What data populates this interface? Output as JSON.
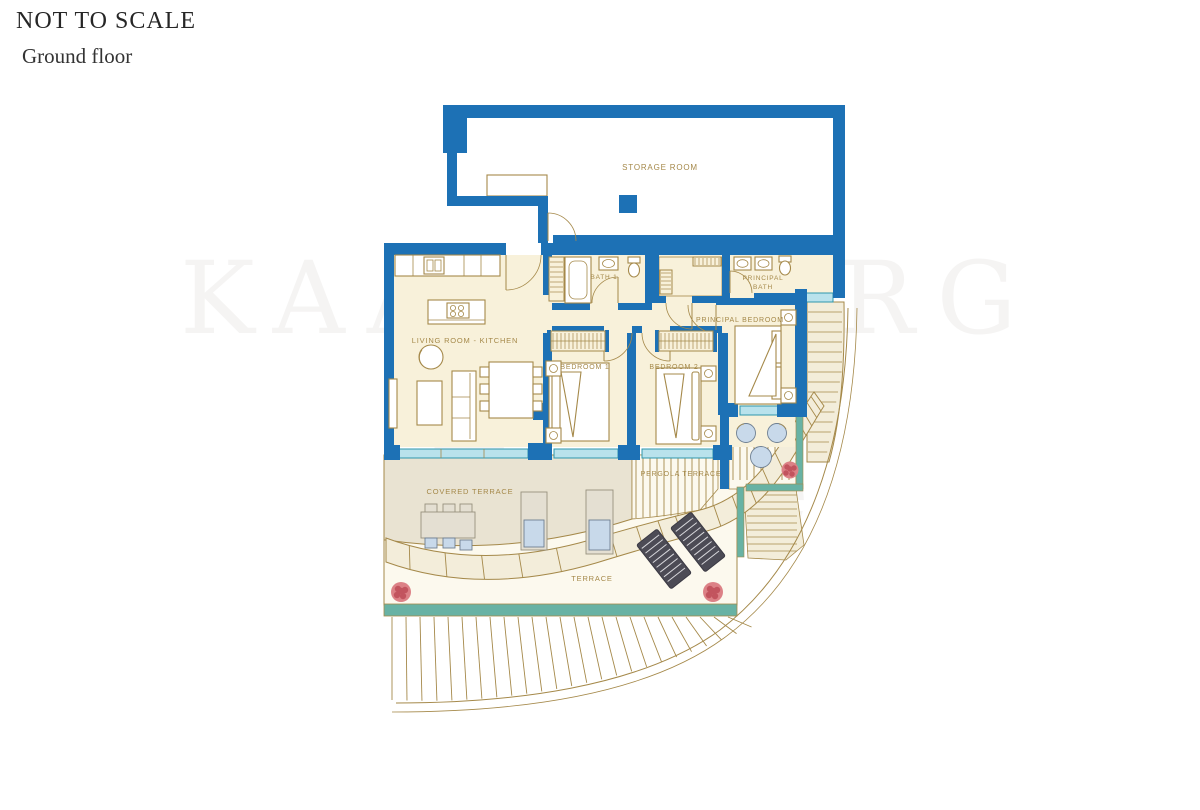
{
  "header": {
    "scale_note": "NOT TO SCALE",
    "floor_label": "Ground floor"
  },
  "watermark": {
    "brand": "KAARSBERG",
    "tagline": "Estate"
  },
  "plan": {
    "type": "floor-plan",
    "rooms": {
      "storage": "STORAGE ROOM",
      "bath1": "BATH 1",
      "principal_bath_line1": "PRINCIPAL",
      "principal_bath_line2": "BATH",
      "living_kitchen": "LIVING ROOM - KITCHEN",
      "bedroom1": "BEDROOM 1",
      "bedroom2": "BEDROOM 2",
      "principal_bedroom": "PRINCIPAL BEDROOM",
      "covered_terrace": "COVERED TERRACE",
      "pergola_terrace": "PERGOLA TERRACE",
      "terrace": "TERRACE"
    }
  },
  "colors": {
    "wall": "#1d71b5",
    "gold": "#a5894a",
    "floor": "#f8f1da",
    "terraceGray": "#e9e3d2",
    "terraceWhite": "#fcf9ee",
    "stepsCream": "#f3edda",
    "glass": "#b9e2ec",
    "glassStroke": "#2e97ad",
    "tealBand": "#68b2a4",
    "plant": "#dc8186",
    "plantDark": "#c2545e",
    "lounger": "#4c4b55",
    "cushion": "#c8d9ea",
    "ink": "#262626",
    "watermarkColor": "rgba(125,115,100,0.08)"
  }
}
